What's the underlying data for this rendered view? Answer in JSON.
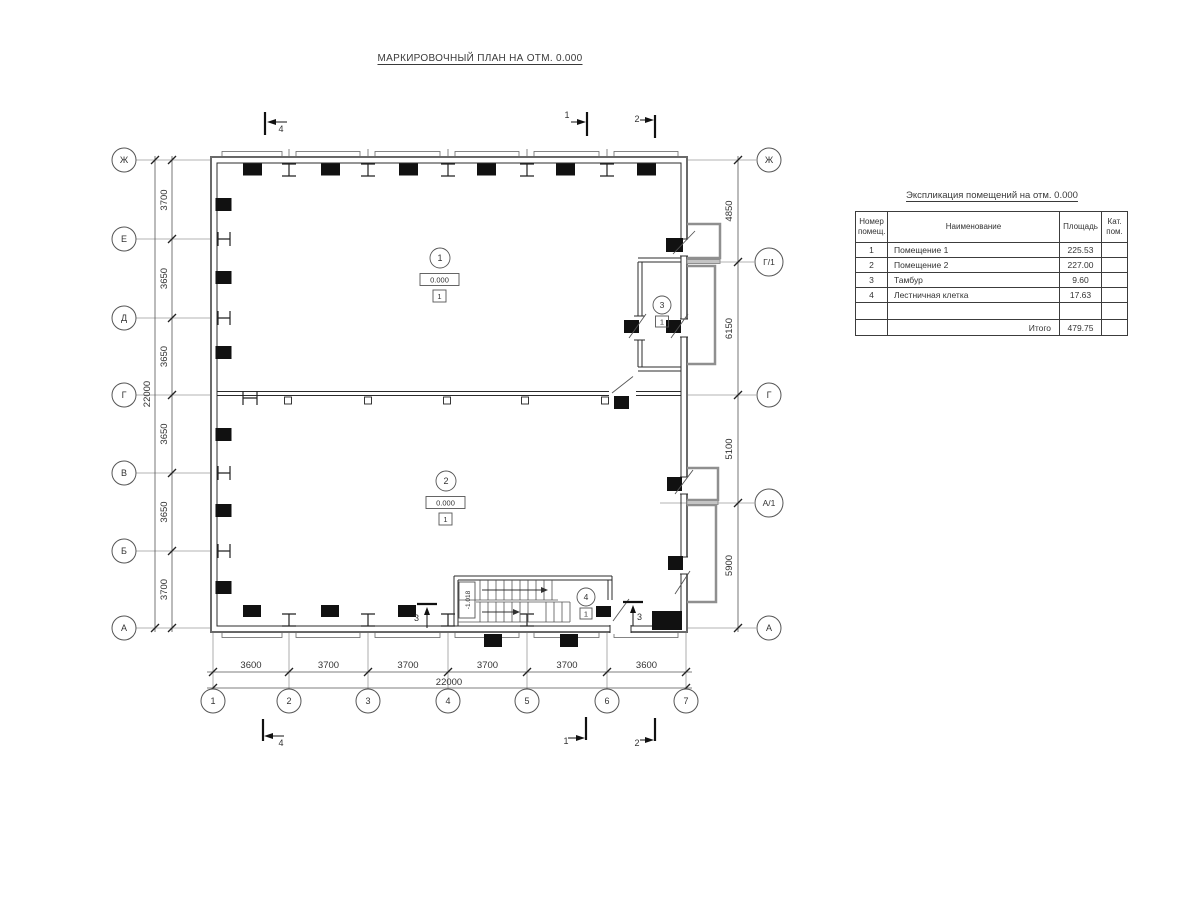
{
  "drawing_title": "МАРКИРОВОЧНЫЙ ПЛАН НА ОТМ. 0.000",
  "colors": {
    "line": "#2b2b2b",
    "aux": "#9a9a9a",
    "porch": "#8f8f8f",
    "fill_black": "#111111"
  },
  "plan": {
    "axes_left": [
      "Ж",
      "Е",
      "Д",
      "Г",
      "В",
      "Б",
      "А"
    ],
    "axes_right": [
      "Ж",
      "Г/1",
      "Г",
      "А/1",
      "А"
    ],
    "axes_bottom": [
      "1",
      "2",
      "3",
      "4",
      "5",
      "6",
      "7"
    ],
    "dims_left_bays": [
      "3700",
      "3650",
      "3650",
      "3650",
      "3650",
      "3700"
    ],
    "dims_left_total": "22000",
    "dims_right_bays": [
      "4850",
      "6150",
      "5100",
      "5900"
    ],
    "dims_bottom_bays": [
      "3600",
      "3700",
      "3700",
      "3700",
      "3700",
      "3600"
    ],
    "dims_bottom_total": "22000",
    "rooms": [
      {
        "number": "1",
        "elevation": "0.000",
        "category": "1"
      },
      {
        "number": "2",
        "elevation": "0.000",
        "category": "1"
      },
      {
        "number": "3",
        "category": "1"
      },
      {
        "number": "4",
        "category": "1"
      }
    ],
    "stair_elevation": "-1.018",
    "sections": {
      "cut1": "1",
      "cut2": "2",
      "cut3": "3",
      "cut4": "4"
    }
  },
  "schedule": {
    "title": "Экспликация помещений на отм. 0.000",
    "headers": {
      "number": "Номер помещ.",
      "name": "Наименование",
      "area": "Площадь",
      "category": "Кат. пом."
    },
    "rows": [
      {
        "number": "1",
        "name": "Помещение 1",
        "area": "225.53",
        "category": ""
      },
      {
        "number": "2",
        "name": "Помещение 2",
        "area": "227.00",
        "category": ""
      },
      {
        "number": "3",
        "name": "Тамбур",
        "area": "9.60",
        "category": ""
      },
      {
        "number": "4",
        "name": "Лестничная клетка",
        "area": "17.63",
        "category": ""
      },
      {
        "number": "",
        "name": "",
        "area": "",
        "category": ""
      }
    ],
    "total_label": "Итого",
    "total_value": "479.75"
  }
}
